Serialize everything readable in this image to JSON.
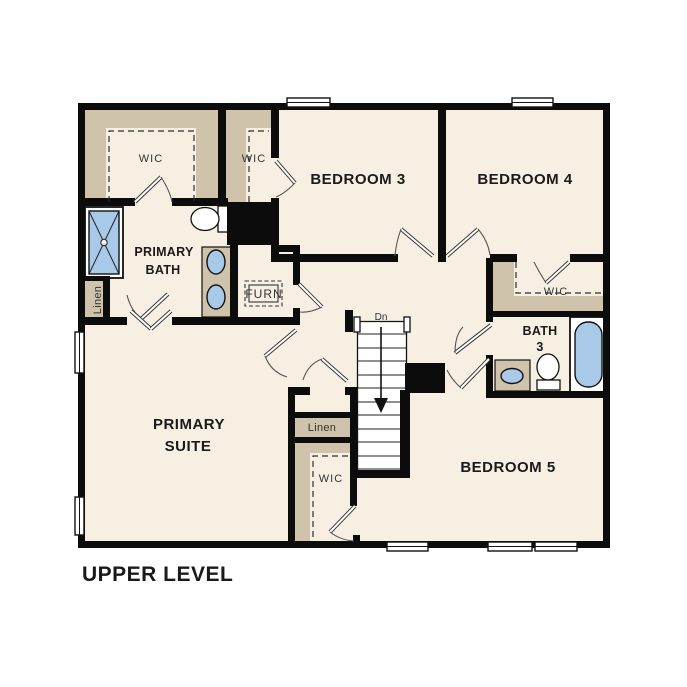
{
  "title": "UPPER LEVEL",
  "colors": {
    "floor": "#f6efe2",
    "shelf": "#cfc3ab",
    "fixture": "#a9c9e9",
    "ink": "#1a1a1a",
    "wall": "#0c0c0c"
  },
  "rooms": {
    "wic_primary": {
      "label": "WIC"
    },
    "wic_bed3": {
      "label": "WIC"
    },
    "bedroom3": {
      "label": "BEDROOM 3"
    },
    "bedroom4": {
      "label": "BEDROOM 4"
    },
    "primary_bath": {
      "line1": "PRIMARY",
      "line2": "BATH"
    },
    "linen_left": {
      "label": "Linen"
    },
    "furnace": {
      "label": "FURN"
    },
    "wic_bed4": {
      "label": "WIC"
    },
    "bath3": {
      "line1": "BATH",
      "line2": "3"
    },
    "primary_suite": {
      "line1": "PRIMARY",
      "line2": "SUITE"
    },
    "linen_hall": {
      "label": "Linen"
    },
    "wic_bed5": {
      "label": "WIC"
    },
    "bedroom5": {
      "label": "BEDROOM 5"
    },
    "stairs": {
      "direction_label": "Dn"
    }
  }
}
